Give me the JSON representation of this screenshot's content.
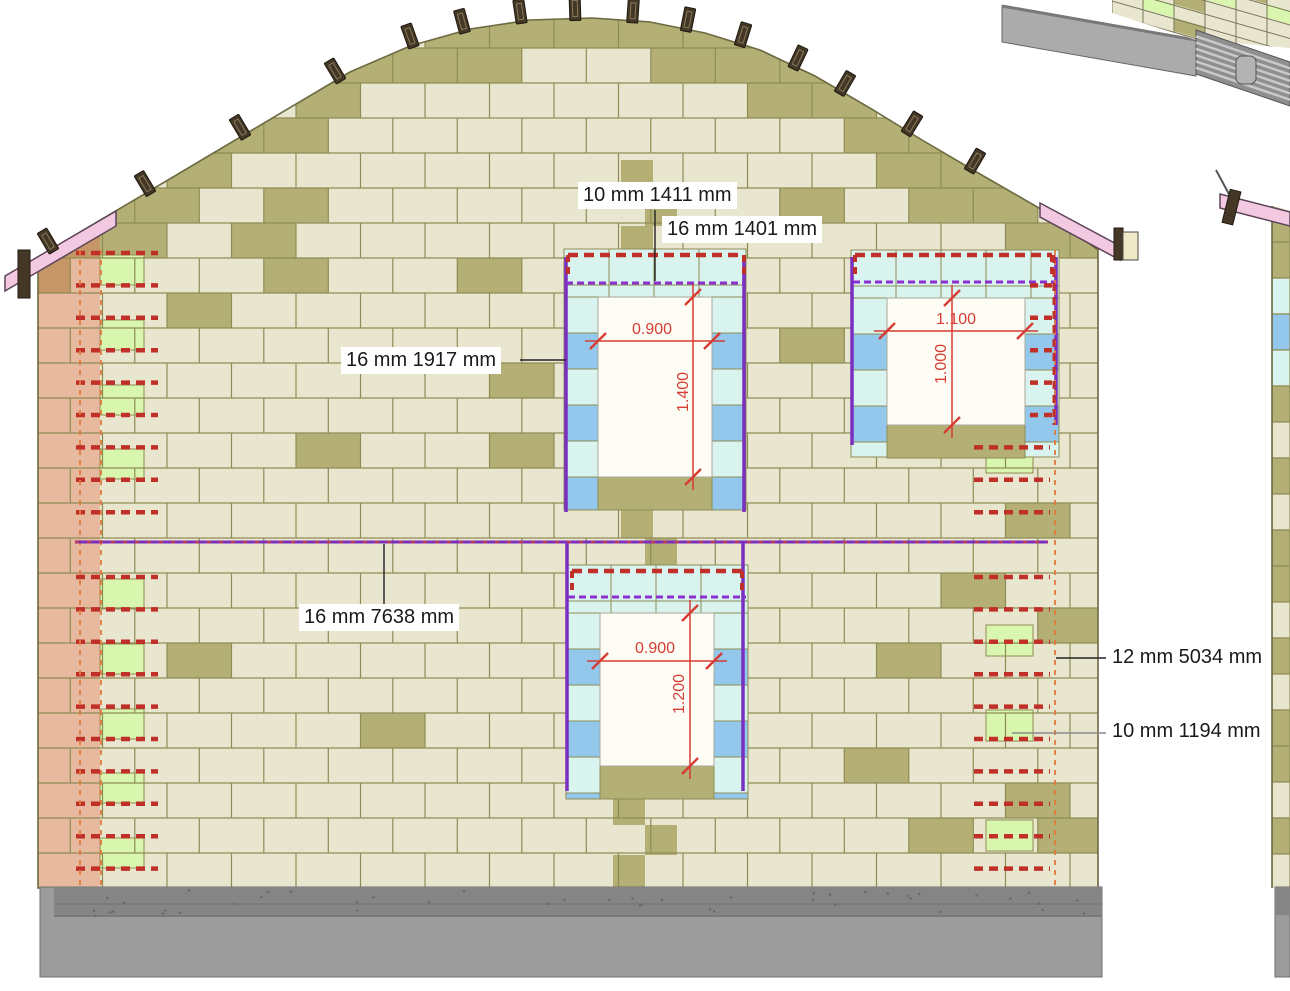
{
  "annotations": {
    "callouts": [
      {
        "text": "10 mm 1411 mm",
        "x": 578,
        "y": 182,
        "leader": [
          [
            655,
            210
          ],
          [
            655,
            281
          ]
        ],
        "leader_color": "black"
      },
      {
        "text": "16 mm 1401 mm",
        "x": 662,
        "y": 216,
        "leader": null,
        "leader_color": "black"
      },
      {
        "text": "16 mm 1917 mm",
        "x": 341,
        "y": 347,
        "leader": [
          [
            520,
            360
          ],
          [
            566,
            360
          ]
        ],
        "leader_color": "black"
      },
      {
        "text": "16 mm 7638 mm",
        "x": 299,
        "y": 604,
        "leader": [
          [
            384,
            604
          ],
          [
            384,
            544
          ]
        ],
        "leader_color": "black"
      },
      {
        "text": "12 mm 5034 mm",
        "x": 1107,
        "y": 644,
        "leader": [
          [
            1106,
            658
          ],
          [
            1056,
            658
          ]
        ],
        "leader_color": "black"
      },
      {
        "text": "10 mm 1194 mm",
        "x": 1107,
        "y": 718,
        "leader": [
          [
            1106,
            733
          ],
          [
            1012,
            733
          ]
        ],
        "leader_color": "gray"
      }
    ]
  },
  "drawing": {
    "canvas": {
      "w": 1290,
      "h": 991
    },
    "colors": {
      "block_base": "#e9e6cf",
      "block_olive": "#b4af74",
      "block_green": "#d9f6ae",
      "block_cyan": "#d9f3ef",
      "block_blue": "#93c7ec",
      "joint": "#8e8c55",
      "outline": "#6b6a40",
      "salmon_overlay": "rgba(228,112,78,0.38)",
      "fascia_pink": "#f3c9e2",
      "fascia_edge": "#5c4458",
      "batten": "#453726",
      "foundation": "#9c9c9c",
      "foundation_dark": "#858585",
      "foundation_edge": "#6f6f6f",
      "rebar_red": "#c03028",
      "rebar_orange": "#e07a3e",
      "bar_purple": "#7a2fc0",
      "lintel_purple": "#8a2fd0",
      "mid_overlay": "#c23b4e",
      "dim_red": "#d63c34",
      "leader": "#222222",
      "leader_gray": "#8a8a8a",
      "opening": "#fdfdf5",
      "slab_gray": "#ababab",
      "joist_gray": "#8f8f8f",
      "joist_light": "#c9c9c9",
      "post_gray": "#b3b3b3",
      "cap_cream": "#efe9c8"
    },
    "wall": {
      "left": 38,
      "right": 1098,
      "bottom": 888,
      "course_h": 35,
      "block_w": 64.5
    },
    "roof_profile": [
      [
        38,
        257
      ],
      [
        200,
        161
      ],
      [
        350,
        72
      ],
      [
        410,
        46
      ],
      [
        470,
        29
      ],
      [
        530,
        20
      ],
      [
        592,
        18
      ],
      [
        650,
        22
      ],
      [
        705,
        33
      ],
      [
        760,
        50
      ],
      [
        815,
        76
      ],
      [
        870,
        108
      ],
      [
        922,
        140
      ],
      [
        980,
        174
      ],
      [
        1046,
        212
      ],
      [
        1098,
        250
      ]
    ],
    "battens_x": [
      48,
      145,
      240,
      335,
      410,
      462,
      520,
      575,
      633,
      688,
      743,
      798,
      845,
      912,
      975
    ],
    "fascia_left": {
      "poly": [
        [
          5,
          276
        ],
        [
          116,
          211
        ],
        [
          116,
          226
        ],
        [
          5,
          291
        ]
      ],
      "cap": [
        18,
        250,
        12,
        48
      ]
    },
    "fascia_right": {
      "poly": [
        [
          1040,
          203
        ],
        [
          1120,
          246
        ],
        [
          1120,
          260
        ],
        [
          1040,
          217
        ]
      ],
      "cap_dark": [
        1114,
        228,
        9,
        32
      ],
      "cap_light": [
        1123,
        232,
        15,
        28
      ]
    },
    "windows": [
      {
        "name": "upper-left",
        "opening": [
          598,
          297,
          114,
          180
        ],
        "surround": [
          564,
          249,
          182,
          261
        ],
        "width_label": "0.900",
        "height_label": "1.400",
        "wdim": {
          "y": 341,
          "x1": 598,
          "x2": 712,
          "label_cx": 652,
          "label_cy": 330
        },
        "hdim": {
          "x": 693,
          "y1": 297,
          "y2": 477,
          "label_cx": 684,
          "label_cy": 392
        },
        "bars": [
          [
            566,
            257,
            512
          ],
          [
            744,
            257,
            512
          ]
        ],
        "lintel_dash_y": 283,
        "red_top": {
          "y": 255,
          "x1": 568,
          "x2": 744
        }
      },
      {
        "name": "upper-right",
        "opening": [
          887,
          298,
          138,
          127
        ],
        "surround": [
          851,
          250,
          208,
          207
        ],
        "width_label": "1.100",
        "height_label": "1.000",
        "wdim": {
          "y": 331,
          "x1": 887,
          "x2": 1025,
          "label_cx": 956,
          "label_cy": 320
        },
        "hdim": {
          "x": 952,
          "y1": 298,
          "y2": 425,
          "label_cx": 942,
          "label_cy": 364
        },
        "bars": [
          [
            852,
            257,
            445
          ],
          [
            1056,
            257,
            425
          ]
        ],
        "lintel_dash_y": 282,
        "red_top": {
          "y": 255,
          "x1": 855,
          "x2": 1052
        }
      },
      {
        "name": "lower-center",
        "opening": [
          600,
          613,
          114,
          153
        ],
        "surround": [
          566,
          565,
          182,
          234
        ],
        "width_label": "0.900",
        "height_label": "1.200",
        "wdim": {
          "y": 661,
          "x1": 600,
          "x2": 714,
          "label_cx": 655,
          "label_cy": 649
        },
        "hdim": {
          "x": 690,
          "y1": 613,
          "y2": 766,
          "label_cx": 680,
          "label_cy": 694
        },
        "bars": [
          [
            567,
            543,
            791
          ],
          [
            743,
            543,
            791
          ]
        ],
        "lintel_dash_y": 597,
        "red_top": {
          "y": 571,
          "x1": 572,
          "x2": 742
        }
      }
    ],
    "mid_bar": {
      "y": 542,
      "x1": 75,
      "x2": 1048
    },
    "left_rebar": {
      "x1": 76,
      "x2": 158,
      "y_start": 253,
      "step": 32.4,
      "count": 20,
      "skip_index": 9
    },
    "right_rebar": {
      "x1": 974,
      "x2": 1050,
      "ys": [
        447.4,
        479.8,
        512.2,
        577,
        609.4,
        641.8,
        674.2,
        706.6,
        739,
        771.4,
        803.8,
        836.2,
        868.6
      ]
    },
    "right_short_rebar": {
      "x1": 1030,
      "x2": 1058,
      "ys": [
        285.4,
        317.8,
        350.2,
        382.6,
        415
      ]
    },
    "vert_orange_x": [
      80,
      101,
      1055
    ],
    "vert_red": {
      "x": 1054,
      "y1": 255,
      "y2": 425
    },
    "green_left": {
      "x": 100,
      "w": 44,
      "h": 30,
      "tops": [
        255,
        320,
        385,
        449,
        579,
        644,
        709,
        773,
        838
      ]
    },
    "green_right": {
      "x": 986,
      "w": 47,
      "h": 31,
      "tops": [
        442,
        625,
        710,
        820
      ]
    },
    "olive_stacks": [
      [
        621,
        160,
        32,
        33
      ],
      [
        645,
        193,
        32,
        33
      ],
      [
        621,
        226,
        32,
        23
      ],
      [
        621,
        510,
        32,
        28
      ],
      [
        645,
        538,
        32,
        27
      ],
      [
        613,
        799,
        32,
        26
      ],
      [
        645,
        825,
        32,
        30
      ],
      [
        613,
        855,
        32,
        32
      ]
    ],
    "salmon": {
      "x": 38,
      "w": 62,
      "y": 228
    },
    "foundation": {
      "x": 40,
      "w": 1062,
      "y": 887,
      "h": 90,
      "dark_x": 54,
      "dark_h": 30,
      "lines": [
        904,
        916
      ]
    },
    "fragment_right": {
      "strip": {
        "x": 1272,
        "w": 18,
        "top": 206,
        "bottom": 888,
        "colors": [
          "olive",
          "olive",
          "cyan",
          "blue",
          "cyan",
          "olive",
          "base",
          "olive",
          "base",
          "olive",
          "olive",
          "base",
          "olive",
          "base",
          "olive",
          "olive",
          "base",
          "olive",
          "base"
        ]
      },
      "fascia": [
        [
          1220,
          194
        ],
        [
          1290,
          212
        ],
        [
          1290,
          226
        ],
        [
          1220,
          208
        ]
      ],
      "batten": [
        1226,
        190,
        11,
        34
      ],
      "pole": [
        [
          1216,
          170
        ],
        [
          1230,
          196
        ]
      ],
      "foundation": [
        1275,
        887,
        15,
        90
      ]
    },
    "fragment_3d": {
      "slab": [
        [
          1002,
          6
        ],
        [
          1196,
          40
        ],
        [
          1196,
          76
        ],
        [
          1002,
          42
        ]
      ],
      "slab_edge": [
        [
          1002,
          6
        ],
        [
          1196,
          40
        ]
      ],
      "blocks_clip": [
        [
          1112,
          0
        ],
        [
          1290,
          0
        ],
        [
          1290,
          48
        ],
        [
          1196,
          40
        ],
        [
          1112,
          13
        ]
      ],
      "skew_deg": 16,
      "block_w": 31,
      "block_h": 13.5,
      "green_cells": [
        [
          1,
          -1
        ],
        [
          3,
          -3
        ],
        [
          5,
          -3
        ]
      ],
      "olive_cells": [
        [
          0,
          -2
        ],
        [
          2,
          -2
        ],
        [
          4,
          -4
        ],
        [
          2,
          0
        ]
      ],
      "joists_band": [
        [
          1196,
          30
        ],
        [
          1290,
          62
        ],
        [
          1290,
          106
        ],
        [
          1196,
          74
        ]
      ],
      "joist_stripes": 6,
      "post": [
        1236,
        56,
        20,
        28
      ]
    }
  }
}
